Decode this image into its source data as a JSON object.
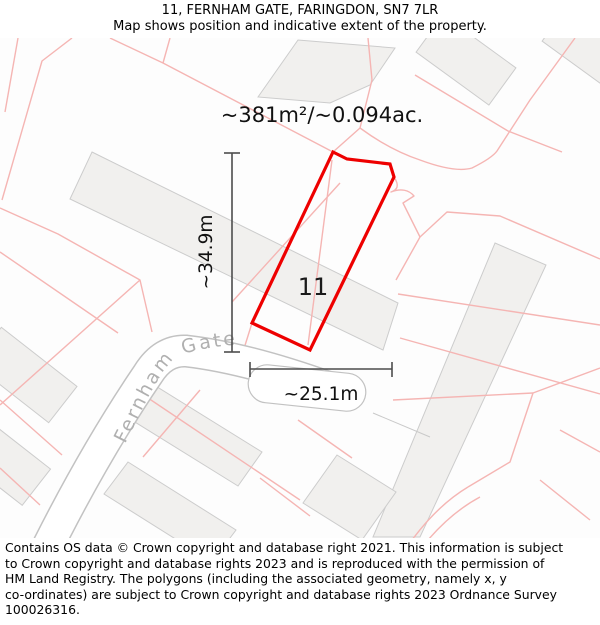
{
  "header": {
    "title": "11, FERNHAM GATE, FARINGDON, SN7 7LR",
    "subtitle": "Map shows position and indicative extent of the property."
  },
  "map": {
    "area_label": "~381m²/~0.094ac.",
    "plot_number": "11",
    "street_label": "Fernham Gate",
    "vertical_dimension": "~34.9m",
    "horizontal_dimension": "~25.1m"
  },
  "colors": {
    "plot_outline": "#ee0000",
    "parcel_line": "#f5b5b3",
    "building_fill": "#f1f0ee",
    "building_stroke": "#cccccc",
    "road_casing": "#c2c2c2",
    "dimension_line": "#4d4d4d",
    "street_label_color": "#b0b0b0"
  },
  "footer": {
    "lines": [
      "Contains OS data © Crown copyright and database right 2021. This information is subject",
      "to Crown copyright and database rights 2023 and is reproduced with the permission of",
      "HM Land Registry. The polygons (including the associated geometry, namely x, y",
      "co-ordinates) are subject to Crown copyright and database rights 2023 Ordnance Survey",
      "100026316."
    ]
  }
}
